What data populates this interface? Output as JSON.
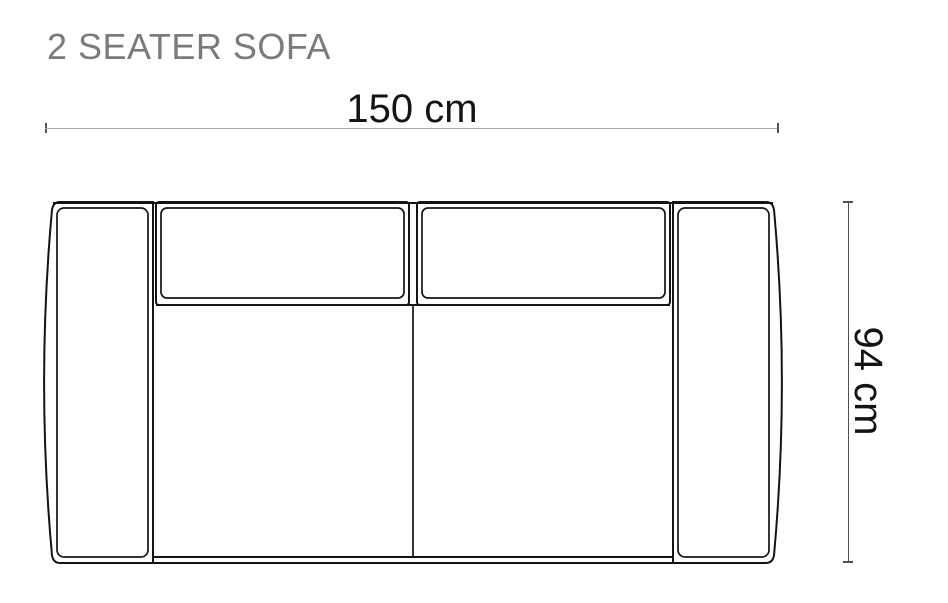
{
  "title": "2 SEATER SOFA",
  "diagram": {
    "subject": "2-seater-sofa-top-view",
    "width_label": "150 cm",
    "depth_label": "94 cm"
  },
  "colors": {
    "background": "#ffffff",
    "title_text": "#7b7b7b",
    "dimension_text": "#141414",
    "sofa_outline": "#141414",
    "horizontal_dim_line": "#a8a8a8",
    "vertical_dim_line": "#4f4f4f",
    "tick": "#555555"
  }
}
